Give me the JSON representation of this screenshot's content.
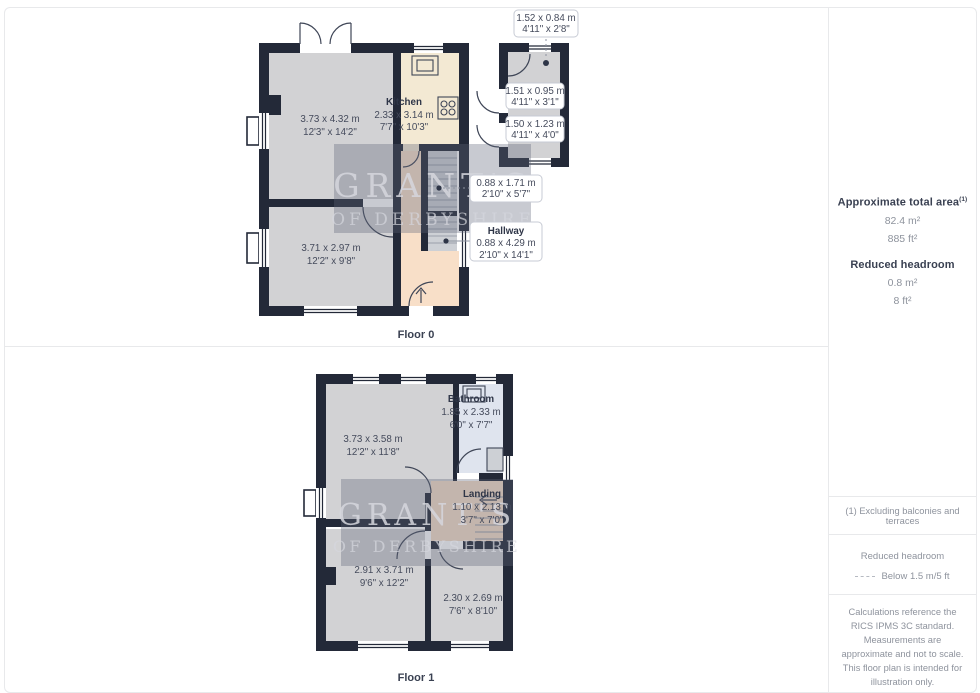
{
  "floor0": {
    "label": "Floor 0",
    "living": {
      "m": "3.73 x 4.32 m",
      "i": "12'3\" x 14'2\""
    },
    "kitchen": {
      "name": "Kitchen",
      "m": "2.33 x 3.14 m",
      "i": "7'7\" x 10'3\""
    },
    "reception": {
      "m": "3.71 x 2.97 m",
      "i": "12'2\" x 9'8\""
    },
    "stairs": {
      "m": "0.88 x 1.71 m",
      "i": "2'10\" x 5'7\""
    },
    "hallway": {
      "name": "Hallway",
      "m": "0.88 x 4.29 m",
      "i": "2'10\" x 14'1\""
    },
    "store1": {
      "m": "1.52 x 0.84 m",
      "i": "4'11\" x 2'8\""
    },
    "store2": {
      "m": "1.51 x 0.95 m",
      "i": "4'11\" x 3'1\""
    },
    "store3": {
      "m": "1.50 x 1.23 m",
      "i": "4'11\" x 4'0\""
    }
  },
  "floor1": {
    "label": "Floor 1",
    "bedroom1": {
      "m": "3.73 x 3.58 m",
      "i": "12'2\" x 11'8\""
    },
    "bathroom": {
      "name": "Bathroom",
      "m": "1.85 x 2.33 m",
      "i": "6'0\" x 7'7\""
    },
    "landing": {
      "name": "Landing",
      "m": "1.10 x 2.13 m",
      "i": "3'7\" x 7'0\""
    },
    "bedroom2": {
      "m": "2.91 x 3.71 m",
      "i": "9'6\" x 12'2\""
    },
    "bedroom3": {
      "m": "2.30 x 2.69 m",
      "i": "7'6\" x 8'10\""
    }
  },
  "watermark": {
    "line1": "GRANT'S",
    "line2": "OF DERBYSHIRE"
  },
  "sidebar": {
    "total_area_title": "Approximate total area",
    "total_area_note_ref": "(1)",
    "total_area_m": "82.4 m²",
    "total_area_ft": "885 ft²",
    "reduced_title": "Reduced headroom",
    "reduced_m": "0.8 m²",
    "reduced_ft": "8 ft²",
    "footnote": "(1) Excluding balconies and terraces",
    "legend_title": "Reduced headroom",
    "legend_item": "Below 1.5 m/5 ft",
    "disclaimer": "Calculations reference the RICS IPMS 3C standard. Measurements are approximate and not to scale. This floor plan is intended for illustration only.",
    "brand_name": "GIRAFFE",
    "brand_number": "360"
  },
  "colors": {
    "wall": "#232938",
    "room_fill": "#d2d2d4",
    "kitchen_fill": "#f3e9d3",
    "hall_fill": "#f8dfc8",
    "bath_fill": "#dfe4ee",
    "text_dark": "#3a4152",
    "text_gray": "#8e939d",
    "divider": "#e8e9eb"
  }
}
